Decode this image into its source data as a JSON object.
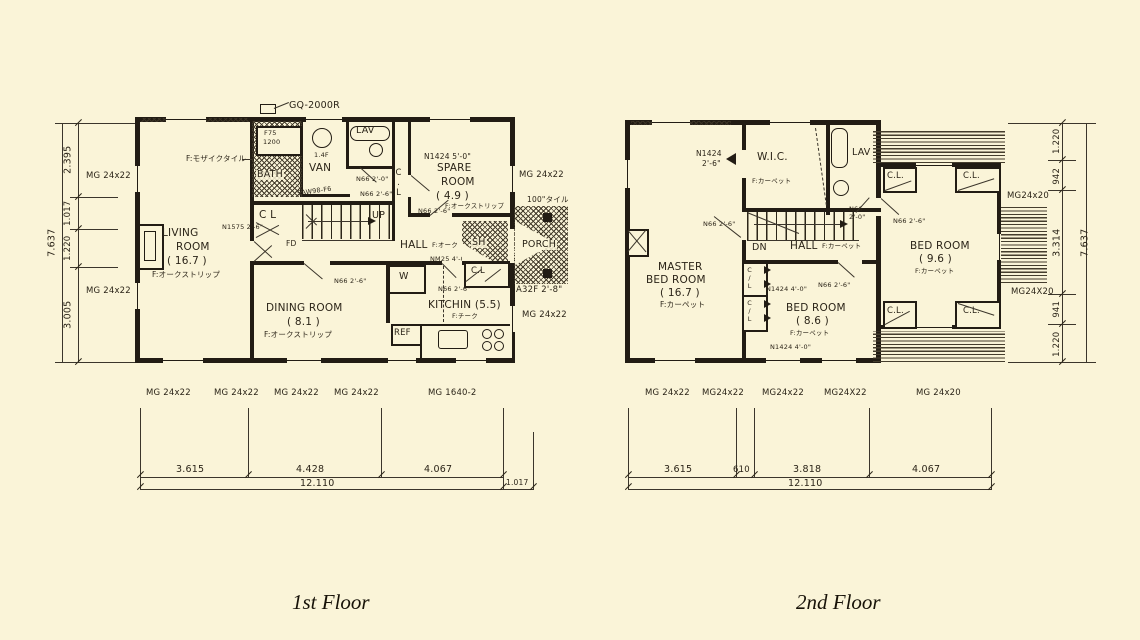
{
  "captions": {
    "f1": "1st Floor",
    "f2": "2nd Floor"
  },
  "f1": {
    "gq": "GQ-2000R",
    "tub_model": "F75",
    "tub_size": "1200",
    "bath": "BATH",
    "lav": "LAV",
    "van": "VAN",
    "van_note": "1.4F",
    "van_window": "5AW98-F6",
    "mosaic": "F:モザイクタイル",
    "n66_lav": "N66 2'-0\"",
    "n66_hall_upper": "N66 2'-6\"",
    "cl_stairs": "C L",
    "up": "UP",
    "fd": "FD",
    "living_door": "N1575 2'-6\"",
    "living": [
      "LIVING",
      "ROOM",
      "( 16.7 )",
      "F:オークストリップ"
    ],
    "spare_window": "N1424 5'-0\"",
    "spare": [
      "SPARE",
      "ROOM",
      "( 4.9 )",
      "F:オークストリップ"
    ],
    "spare_door": "N66 2'-6\"",
    "cl_corridor": "C.L",
    "hall": "HALL",
    "hall_floor": "F:オーク",
    "hall_door": "NM25 4'-0\"",
    "n66_dining": "N66 2'-6\"",
    "w_closet": "W",
    "n66_kitchen": "N66 2'-6\"",
    "sh": "SH",
    "cl_entry": "C.L",
    "porch": "PORCH",
    "tile": "100\"タイル",
    "entry_door": "A32F 2'-8\"",
    "kitchen": "KITCHIN (5.5)",
    "kitchen_floor": "F:チーク",
    "ref": "REF",
    "dining": [
      "DINING ROOM",
      "( 8.1 )",
      "F:オークストリップ"
    ],
    "side_right": [
      "MG 24x22",
      "MG 24x22"
    ],
    "side_left": [
      "MG 24x22",
      "MG 24x22"
    ],
    "bottom_windows": [
      "MG 24x22",
      "MG 24x22",
      "MG 24x22",
      "MG 24x22",
      "MG 1640-2"
    ],
    "dim_left_total": "7.637",
    "dim_left": [
      "2.395",
      "1.017",
      "1.220",
      "3.005"
    ],
    "dim_bottom": [
      "3.615",
      "4.428",
      "4.067"
    ],
    "dim_bottom_total": "12.110",
    "dim_porch": "1.017"
  },
  "f2": {
    "master_door1": "N1424",
    "master_door2": "2'-6\"",
    "wic": "W.I.C.",
    "wic_floor": "F:カーペット",
    "lav": "LAV",
    "lav_door1": "N66",
    "lav_door2": "2'-0\"",
    "n66_master": "N66 2'-6\"",
    "dn": "DN",
    "hall": "HALL",
    "hall_floor": "F:カーペット",
    "master": [
      "MASTER",
      "BED ROOM",
      "( 16.7 )",
      "F:カーペット"
    ],
    "bed2_window_top": "N1424 4'-0\"",
    "bed2_door": "N66 2'-6\"",
    "bed2": [
      "BED ROOM",
      "( 8.6 )",
      "F:カーペット"
    ],
    "bed2_window_bottom": "N1424 4'-0\"",
    "cl_a": "C/L",
    "cl_b": "C/L",
    "bed3_door": "N66 2'-6\"",
    "bed3": [
      "BED ROOM",
      "( 9.6 )",
      "F:カーペット"
    ],
    "closets": [
      "C.L.",
      "C.L.",
      "C.L.",
      "C.L."
    ],
    "side_right": [
      "MG24x20",
      "MG24X20"
    ],
    "bottom_windows": [
      "MG 24x22",
      "MG24x22",
      "MG24x22",
      "MG24X22",
      "MG 24x20"
    ],
    "dim_right_total": "7.637",
    "dim_right": [
      "1.220",
      "942",
      "3.314",
      "941",
      "1.220"
    ],
    "dim_bottom": [
      "3.615",
      "610",
      "3.818",
      "4.067"
    ],
    "dim_bottom_total": "12.110"
  }
}
